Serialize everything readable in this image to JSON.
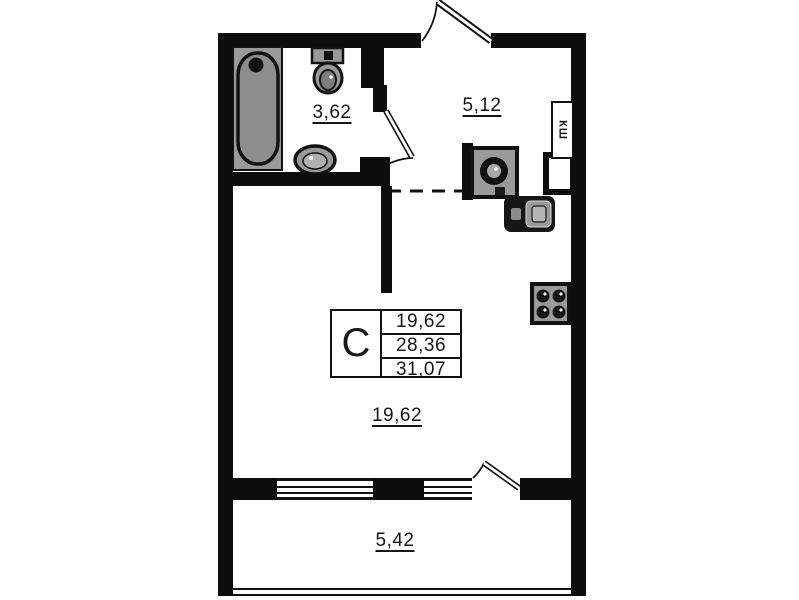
{
  "plan": {
    "title": "studio-apartment-floor-plan",
    "rooms": [
      {
        "id": "bathroom",
        "area_label": "3,62"
      },
      {
        "id": "hallway",
        "area_label": "5,12"
      },
      {
        "id": "living-room",
        "area_label": "19,62"
      },
      {
        "id": "balcony",
        "area_label": "5,42"
      }
    ],
    "closet_label": "КШ",
    "info_table": {
      "type_label": "С",
      "rows": [
        "19,62",
        "28,36",
        "31,07"
      ]
    },
    "fixtures": [
      "bathtub",
      "toilet",
      "bathroom-sink",
      "washing-machine",
      "kitchen-sink",
      "stove",
      "ventilation-shaft",
      "closet"
    ],
    "colors": {
      "wall": "#0d0d0d",
      "fixture_gray": "#9a9a9a",
      "fixture_dark_gray": "#7e7e7e",
      "background": "#ffffff"
    }
  }
}
